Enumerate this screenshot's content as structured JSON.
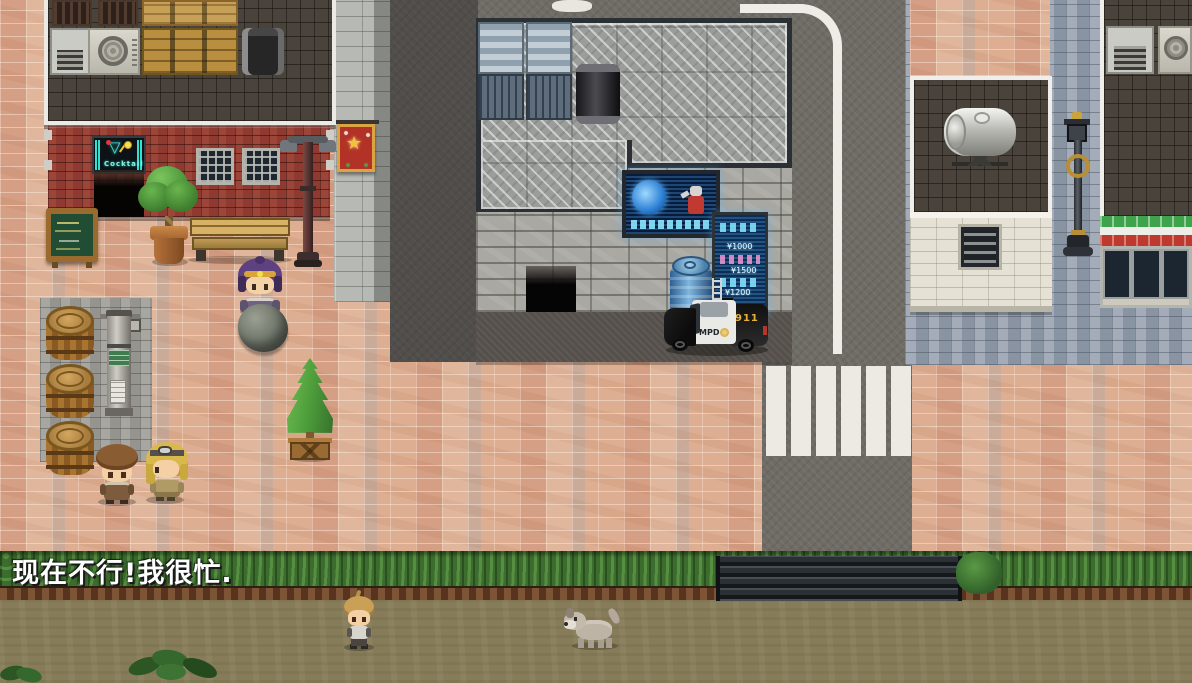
{
  "scene": {
    "dialogue_text": "现在不行!我很忙.",
    "neon_sign_label": "Cocktail",
    "police_car": {
      "door_label": "MPD",
      "rear_label": "911"
    },
    "vending_machine": {
      "prices": [
        "¥1000",
        "¥1500",
        "¥1200"
      ]
    },
    "banner_star": "★",
    "palette": {
      "sidewalk_pink": "#dcae92",
      "cobblestone_blue": "#96a1ae",
      "road_asphalt": "#6f6b65",
      "red_brick": "#8e3a30",
      "hedge_green": "#3c6c2e",
      "dirt_ground": "#867c59",
      "awning_green": "#3da44c",
      "awning_red": "#bf3a2e",
      "hologram_blue": "#0a2c55",
      "neon_cyan": "#7ef2e2",
      "police_gold": "#e8b23a"
    },
    "characters": [
      {
        "id": "hooded-woman",
        "desc": "purple hooded npc"
      },
      {
        "id": "brown-haired-man",
        "desc": "npc facing right"
      },
      {
        "id": "blonde-goggles-woman",
        "desc": "npc facing left"
      },
      {
        "id": "boy",
        "desc": "child npc on dirt path"
      },
      {
        "id": "dog",
        "desc": "stray dog"
      }
    ],
    "objects": [
      "wooden-barrel",
      "metal-signpost",
      "chalkboard-sign",
      "neon-bar-sign",
      "potted-tree",
      "bench",
      "street-lamp",
      "red-banner",
      "topiary-tree",
      "boulder",
      "holographic-billboard",
      "hologram-vending-machine",
      "recycle-bin",
      "police-car",
      "water-tank",
      "wall-vent",
      "antique-street-lamp",
      "store-awning",
      "crosswalk",
      "stair-steps"
    ]
  }
}
